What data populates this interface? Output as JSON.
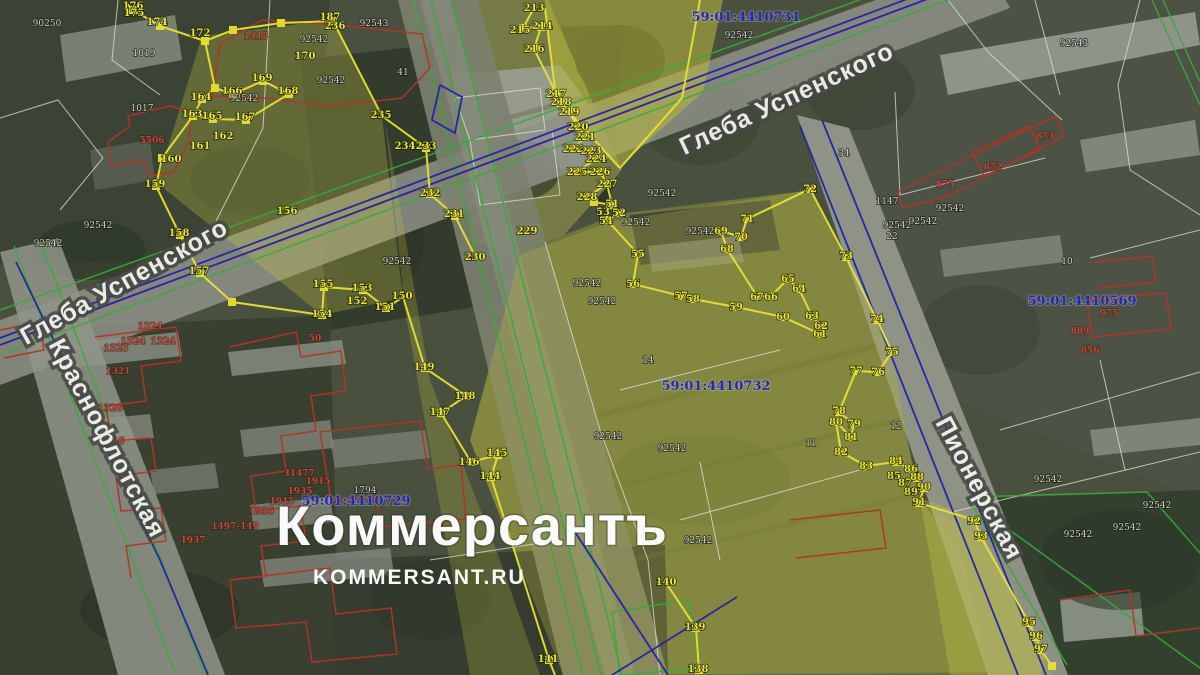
{
  "palette": {
    "yellow_line": "#e6e232",
    "yellow_label": "#eae432",
    "red_line": "#b23428",
    "red_label": "#cc4438",
    "green_line": "#3aa83a",
    "blue_line": "#2222a8",
    "quarter_label": "#2626bc",
    "gray_label": "#d4d4cc",
    "white_line": "#e4e4dc",
    "street_label": "#f2f2ee",
    "watermark": "#ffffff"
  },
  "watermark": {
    "title": "Коммерсантъ",
    "site": "KOMMERSANT.RU"
  },
  "cadastral_quarters": [
    {
      "id": "59:01:4410731",
      "x": 746,
      "y": 17
    },
    {
      "id": "59:01:4410569",
      "x": 1082,
      "y": 301
    },
    {
      "id": "59:01:4410732",
      "x": 716,
      "y": 386
    },
    {
      "id": "59:01:4410729",
      "x": 356,
      "y": 501
    }
  ],
  "streets": [
    {
      "name": "Глеба Успенского",
      "x": 128,
      "y": 289,
      "rotate": -29,
      "size": 25
    },
    {
      "name": "Глеба Успенского",
      "x": 790,
      "y": 106,
      "rotate": -25,
      "size": 25
    },
    {
      "name": "Краснофлотская",
      "x": 100,
      "y": 442,
      "rotate": 62,
      "size": 25
    },
    {
      "name": "Пионерская",
      "x": 972,
      "y": 492,
      "rotate": 62,
      "size": 23
    }
  ],
  "vertex_labels": [
    [
      "176",
      133,
      6
    ],
    [
      "175",
      134,
      13
    ],
    [
      "174",
      157,
      22
    ],
    [
      "172",
      200,
      33
    ],
    [
      "187",
      330,
      17
    ],
    [
      "236",
      335,
      26
    ],
    [
      "170",
      305,
      56
    ],
    [
      "169",
      262,
      78
    ],
    [
      "168",
      288,
      91
    ],
    [
      "166",
      232,
      91
    ],
    [
      "164",
      201,
      97
    ],
    [
      "163",
      192,
      114
    ],
    [
      "165",
      212,
      116
    ],
    [
      "167",
      245,
      117
    ],
    [
      "162",
      223,
      136
    ],
    [
      "161",
      200,
      146
    ],
    [
      "160",
      171,
      159
    ],
    [
      "159",
      155,
      184
    ],
    [
      "235",
      381,
      115
    ],
    [
      "234",
      405,
      146
    ],
    [
      "233",
      426,
      146
    ],
    [
      "232",
      430,
      193
    ],
    [
      "231",
      454,
      214
    ],
    [
      "230",
      475,
      257
    ],
    [
      "229",
      527,
      231
    ],
    [
      "158",
      179,
      233
    ],
    [
      "156",
      287,
      211
    ],
    [
      "157",
      199,
      271
    ],
    [
      "155",
      323,
      284
    ],
    [
      "153",
      362,
      288
    ],
    [
      "152",
      357,
      301
    ],
    [
      "154",
      322,
      314
    ],
    [
      "151",
      385,
      307
    ],
    [
      "150",
      402,
      296
    ],
    [
      "149",
      424,
      367
    ],
    [
      "148",
      465,
      396
    ],
    [
      "147",
      440,
      412
    ],
    [
      "146",
      469,
      462
    ],
    [
      "145",
      497,
      453
    ],
    [
      "144",
      490,
      476
    ],
    [
      "141",
      548,
      659
    ],
    [
      "140",
      666,
      582
    ],
    [
      "139",
      695,
      627
    ],
    [
      "138",
      698,
      669
    ],
    [
      "213",
      534,
      8
    ],
    [
      "215",
      520,
      30
    ],
    [
      "214",
      542,
      26
    ],
    [
      "216",
      534,
      49
    ],
    [
      "217",
      556,
      94
    ],
    [
      "218",
      561,
      102
    ],
    [
      "219",
      569,
      112
    ],
    [
      "220",
      578,
      127
    ],
    [
      "221",
      585,
      137
    ],
    [
      "222",
      573,
      149
    ],
    [
      "223",
      591,
      151
    ],
    [
      "224",
      596,
      159
    ],
    [
      "225",
      577,
      172
    ],
    [
      "226",
      600,
      172
    ],
    [
      "227",
      607,
      184
    ],
    [
      "228",
      587,
      197
    ],
    [
      "51",
      612,
      204
    ],
    [
      "52",
      619,
      213
    ],
    [
      "53",
      603,
      212
    ],
    [
      "54",
      606,
      221
    ],
    [
      "55",
      638,
      254
    ],
    [
      "56",
      633,
      284
    ],
    [
      "57",
      681,
      296
    ],
    [
      "58",
      693,
      299
    ],
    [
      "59",
      736,
      307
    ],
    [
      "60",
      783,
      317
    ],
    [
      "61",
      820,
      334
    ],
    [
      "62",
      821,
      326
    ],
    [
      "63",
      812,
      316
    ],
    [
      "64",
      799,
      289
    ],
    [
      "65",
      788,
      279
    ],
    [
      "66",
      771,
      297
    ],
    [
      "67",
      757,
      297
    ],
    [
      "68",
      727,
      249
    ],
    [
      "69",
      721,
      231
    ],
    [
      "70",
      741,
      237
    ],
    [
      "71",
      747,
      219
    ],
    [
      "72",
      810,
      189
    ],
    [
      "73",
      846,
      256
    ],
    [
      "74",
      877,
      319
    ],
    [
      "75",
      892,
      352
    ],
    [
      "76",
      878,
      372
    ],
    [
      "77",
      856,
      371
    ],
    [
      "78",
      839,
      411
    ],
    [
      "79",
      854,
      424
    ],
    [
      "80",
      836,
      422
    ],
    [
      "81",
      851,
      437
    ],
    [
      "82",
      841,
      452
    ],
    [
      "83",
      866,
      466
    ],
    [
      "84",
      896,
      461
    ],
    [
      "85",
      894,
      476
    ],
    [
      "86",
      911,
      469
    ],
    [
      "87",
      905,
      483
    ],
    [
      "88",
      917,
      477
    ],
    [
      "89",
      911,
      492
    ],
    [
      "90",
      924,
      487
    ],
    [
      "91",
      919,
      502
    ],
    [
      "92",
      974,
      521
    ],
    [
      "93",
      981,
      536
    ],
    [
      "95",
      1029,
      622
    ],
    [
      "96",
      1036,
      636
    ],
    [
      "97",
      1041,
      649
    ]
  ],
  "parcel_labels_red": [
    [
      "1415",
      256,
      36
    ],
    [
      "5506",
      152,
      140
    ],
    [
      "1324",
      150,
      326
    ],
    [
      "1324",
      133,
      341
    ],
    [
      "1324",
      163,
      341
    ],
    [
      "1323",
      116,
      348
    ],
    [
      "1321",
      118,
      371
    ],
    [
      "1326",
      110,
      408
    ],
    [
      "1316",
      112,
      441
    ],
    [
      "50",
      315,
      338
    ],
    [
      "31477",
      299,
      473
    ],
    [
      "1915",
      318,
      481
    ],
    [
      "1935",
      300,
      491
    ],
    [
      "1915",
      282,
      501
    ],
    [
      "1935",
      262,
      511
    ],
    [
      "1497-149",
      235,
      526
    ],
    [
      "1937",
      193,
      540
    ],
    [
      "872",
      993,
      167
    ],
    [
      "875",
      945,
      184
    ],
    [
      "873",
      1045,
      136
    ],
    [
      "975",
      1109,
      313
    ],
    [
      "889",
      1080,
      331
    ],
    [
      "856",
      1090,
      350
    ]
  ],
  "parcel_labels_gray": [
    [
      "90250",
      47,
      23
    ],
    [
      "1019",
      144,
      53
    ],
    [
      "1017",
      142,
      108
    ],
    [
      "92542",
      244,
      98
    ],
    [
      "92543",
      374,
      23
    ],
    [
      "92542",
      314,
      39
    ],
    [
      "92542",
      331,
      80
    ],
    [
      "41",
      403,
      72
    ],
    [
      "92542",
      739,
      35
    ],
    [
      "92543",
      1074,
      43
    ],
    [
      "92542",
      98,
      225
    ],
    [
      "92542",
      48,
      243
    ],
    [
      "92542",
      397,
      261
    ],
    [
      "92542",
      636,
      222
    ],
    [
      "92542",
      662,
      193
    ],
    [
      "92542",
      700,
      231
    ],
    [
      "92542",
      587,
      283
    ],
    [
      "92542",
      602,
      301
    ],
    [
      "14",
      648,
      360
    ],
    [
      "34",
      844,
      153
    ],
    [
      "92542",
      698,
      540
    ],
    [
      "92542",
      1078,
      534
    ],
    [
      "92542",
      1127,
      527
    ],
    [
      "92542",
      1157,
      505
    ],
    [
      "1147",
      887,
      201
    ],
    [
      "92542",
      950,
      208
    ],
    [
      "92542",
      923,
      221
    ],
    [
      "92542",
      897,
      225
    ],
    [
      "22",
      892,
      236
    ],
    [
      "10",
      1067,
      261
    ],
    [
      "12",
      896,
      426
    ],
    [
      "11",
      811,
      443
    ],
    [
      "92542",
      1048,
      479
    ],
    [
      "1794",
      365,
      490
    ],
    [
      "92542",
      608,
      436
    ],
    [
      "92542",
      672,
      448
    ]
  ]
}
